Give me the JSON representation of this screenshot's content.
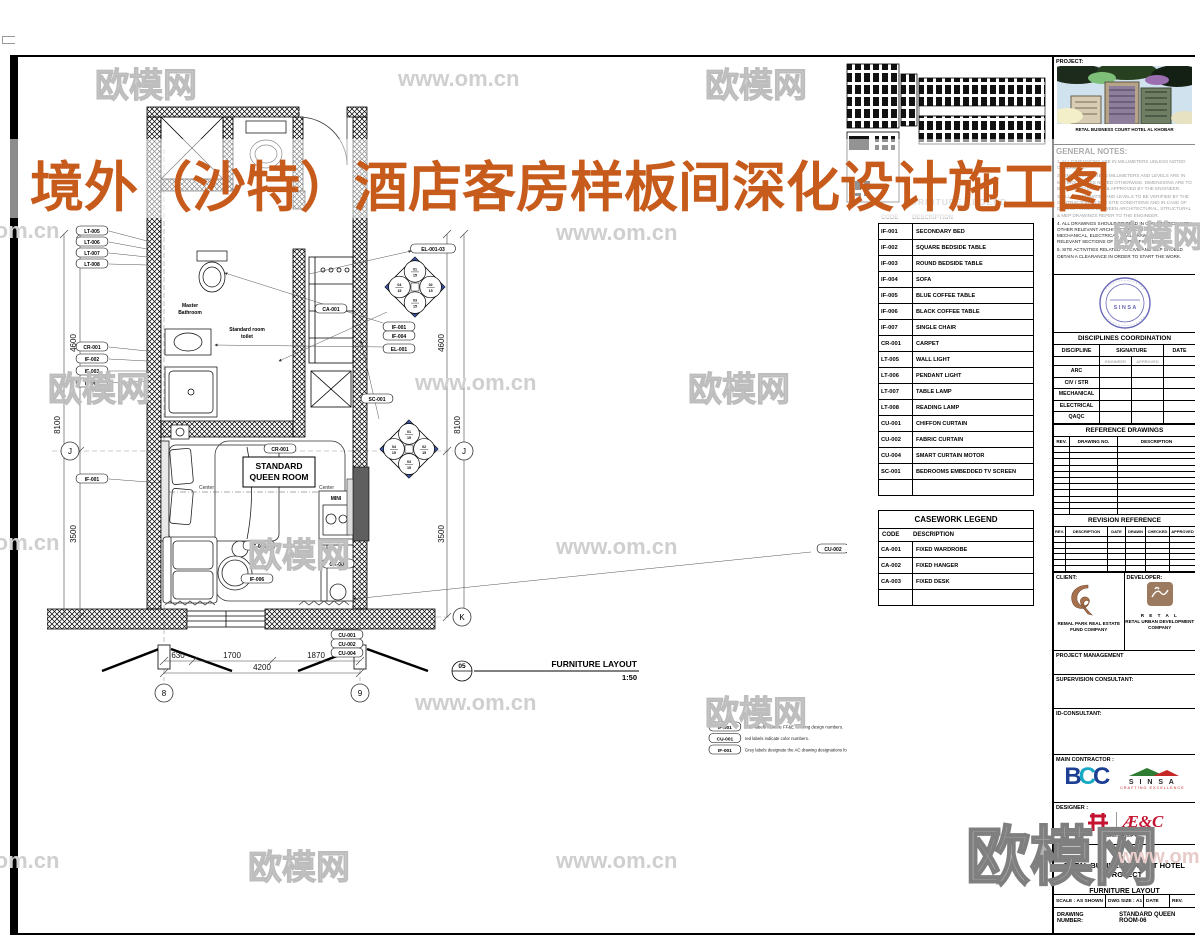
{
  "watermark": {
    "brand": "欧模网",
    "url": "www.om.cn"
  },
  "title_overlay": {
    "text": "境外（沙特）酒店客房样板间深化设计施工图",
    "color": "#c75b1c"
  },
  "plan": {
    "room_label_1": "STANDARD",
    "room_label_2": "QUEEN ROOM",
    "master_bath_1": "Master",
    "master_bath_2": "Bathroom",
    "toilet_1": "Standard room",
    "toilet_2": "toilet",
    "minibar": "MINI",
    "center_left": "Center",
    "center_right": "Center",
    "grid": {
      "col8": "8",
      "col9": "9",
      "rowJ": "J",
      "rowK": "K"
    },
    "dims": {
      "b1": "630",
      "b2": "1700",
      "b3": "1870",
      "btotal": "4200",
      "v1": "4600",
      "v2": "3500",
      "vtotal": "8100",
      "v1r": "4600",
      "v2r": "3500",
      "vtotalr": "8100"
    },
    "callouts_left_top": [
      "LT-005",
      "LT-006",
      "LT-007",
      "LT-008"
    ],
    "callouts_left_mid": [
      "CR-001",
      "IF-002",
      "IF-003",
      "IF-004"
    ],
    "callouts_left_low": [
      "IF-001"
    ],
    "callouts_right": [
      "EL-001-03",
      "IF-001",
      "IF-004",
      "EL-001"
    ],
    "callout_far_right": "CU-002",
    "curtain_codes": [
      "CU-001",
      "CU-002",
      "CU-004"
    ],
    "pills": {
      "wardrobe": "CA-001",
      "desk": "CA-003",
      "carpet": "CR-001",
      "table_small": "IF-005",
      "table_large": "IF-006",
      "tv": "SC-001"
    },
    "elevation_quads": [
      "01/15",
      "02/15",
      "03/15",
      "04/15"
    ],
    "view_title": {
      "bubble": "05",
      "name": "FURNITURE LAYOUT",
      "scale": "1:50"
    },
    "notes": [
      {
        "code": "IF-001",
        "text": "Blue labels indicate FF&E drawing design numbers."
      },
      {
        "code": "CU-001",
        "text": "red labels indicate color numbers."
      },
      {
        "code": "IF-001",
        "text": "Grey labels designate the AC drawing designations for sanitary fixtures"
      }
    ]
  },
  "furniture_legend": {
    "title": "FURNITURE LEGEND",
    "col_code": "CODE",
    "col_desc": "DESCRIPTION",
    "rows": [
      [
        "IF-001",
        "SECONDARY BED"
      ],
      [
        "IF-002",
        "SQUARE BEDSIDE TABLE"
      ],
      [
        "IF-003",
        "ROUND BEDSIDE TABLE"
      ],
      [
        "IF-004",
        "SOFA"
      ],
      [
        "IF-005",
        "BLUE COFFEE TABLE"
      ],
      [
        "IF-006",
        "BLACK COFFEE TABLE"
      ],
      [
        "IF-007",
        "SINGLE CHAIR"
      ],
      [
        "CR-001",
        "CARPET"
      ],
      [
        "LT-005",
        "WALL LIGHT"
      ],
      [
        "LT-006",
        "PENDANT LIGHT"
      ],
      [
        "LT-007",
        "TABLE LAMP"
      ],
      [
        "LT-008",
        "READING LAMP"
      ],
      [
        "CU-001",
        "CHIFFON CURTAIN"
      ],
      [
        "CU-002",
        "FABRIC CURTAIN"
      ],
      [
        "CU-004",
        "SMART CURTAIN MOTOR"
      ],
      [
        "SC-001",
        "BEDROOMS EMBEDDED TV SCREEN"
      ]
    ]
  },
  "casework_legend": {
    "title": "CASEWORK LEGEND",
    "col_code": "CODE",
    "col_desc": "DESCRIPTION",
    "rows": [
      [
        "CA-001",
        "FIXED WARDROBE"
      ],
      [
        "CA-002",
        "FIXED HANGER"
      ],
      [
        "CA-003",
        "FIXED DESK"
      ]
    ]
  },
  "titleblock": {
    "project_label": "PROJECT:",
    "project_caption": "RETAL BUSINESS COURT HOTEL AL KHOBAR",
    "general_notes_title": "GENERAL NOTES:",
    "general_notes": [
      "1. ALL DIMENSIONS ARE IN MILLIMETERS UNLESS NOTED OTHERWISE.",
      "2. DIMENSIONS ARE IN MILLIMETERS AND LEVELS ARE IN METERS UNLESS NOTED OTHERWISE. DIMENSIONS ARE TO BE VERIFIED ON SITE & APPROVED BY THE ENGINEER.",
      "3. ALL COORDINATES AND LEVELS TO BE VERIFIED BY THE CONTRACTOR AS PER SITE CONDITIONS AND IN CASE OF DISCREPANCIES BETWEEN ARCHITECTURAL, STRUCTURAL & MEP DRAWINGS REFER TO THE ENGINEER.",
      "4. ALL DRAWINGS SHOULD BE READ IN CONJUNCTION WITH OTHER RELEVANT ARCHITECTURAL, STRUCTURAL, MECHANICAL, ELECTRICAL, CIVIL DRAWINGS AND RELEVANT SECTIONS OF THE SPECIFICATION.",
      "5. SITE ACTIVITIES RELATED TO CIVIL AND MEP SHOULD OBTAIN A CLEARANCE IN ORDER TO START THE WORK."
    ],
    "stamp_text": "S I N S A",
    "disciplines": {
      "title": "DISCIPLINES COORDINATION",
      "col1": "DISCIPLINE",
      "col2": "SIGNATURE",
      "col3": "DATE",
      "sig_sub": [
        "ENGINEER",
        "APPROVED"
      ],
      "rows": [
        "ARC",
        "CIV / STR",
        "MECHANICAL",
        "ELECTRICAL",
        "QAQC",
        "FLS"
      ]
    },
    "reference_drawings": {
      "title": "REFERENCE DRAWINGS",
      "col1": "REV.",
      "col2": "DRAWING  NO.",
      "col3": "DESCRIPTION",
      "empty_rows": 13
    },
    "revision_reference": {
      "title": "REVISION REFERENCE",
      "cols": [
        "REV.",
        "DESCRIPTION",
        "DATE",
        "DRAWN",
        "CHECKED",
        "APPROVED"
      ],
      "empty_rows": 7
    },
    "client": {
      "label": "CLIENT:",
      "name": "REMAL PARK REAL ESTATE FUND COMPANY"
    },
    "developer": {
      "label": "DEVELOPER:",
      "brand": "R E T A L",
      "name": "RETAL URBAN DEVELOPMENT COMPANY"
    },
    "project_management_label": "PROJECT MANAGEMENT",
    "supervision_label": "SUPERVISION CONSULTANT:",
    "id_consultant_label": "ID-CONSULTANT:",
    "main_contractor_label": "MAIN CONTRACTOR :",
    "contractor_logos": {
      "bcc": "BCC",
      "sinsa": "S I N S A",
      "sinsa_sub": "CRAFTING EXCELLENCE"
    },
    "designer_label": "DESIGNER :",
    "designer_logos": {
      "aec": "Æ&C",
      "sub": "AE&C GROUP PLC"
    },
    "title_label": "TITLE :",
    "doc_title1": "RETAL BUSINESS COURT HOTEL PROJECT",
    "doc_title2": "FURNITURE LAYOUT",
    "scale_row": {
      "scale_label": "SCALE :",
      "scale": "AS SHOWN",
      "size_label": "DWG SIZE :",
      "size": "A1",
      "date_label": "DATE",
      "rev_label": "REV."
    },
    "drawing_number_label": "DRAWING NUMBER:",
    "drawing_number": "STANDARD QUEEN ROOM-06"
  }
}
